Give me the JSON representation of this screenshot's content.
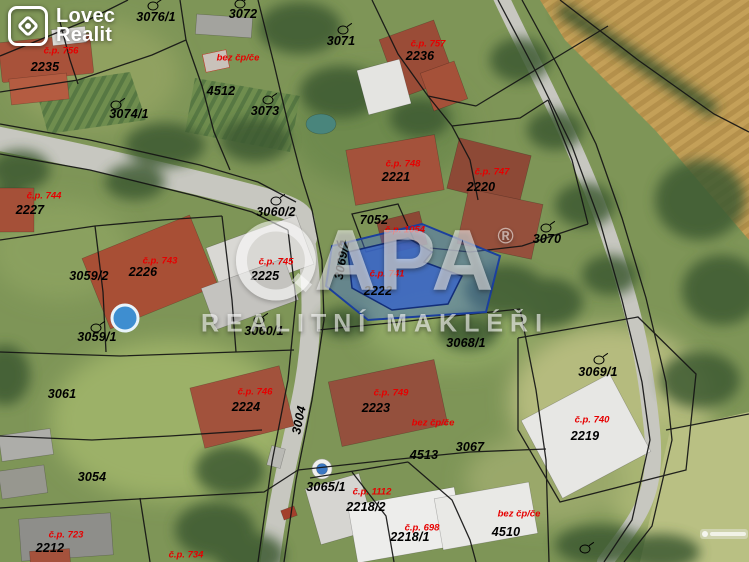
{
  "logo": {
    "line1": "Lovec",
    "line2": "Realit"
  },
  "watermark": {
    "brand": "APA",
    "registered": "®",
    "subtitle": "REALITNÍ MAKLÉŘI"
  },
  "colors": {
    "parcel_label": "#000000",
    "house_label": "#e60000",
    "highlight_fill": "#4672d7",
    "highlight_stroke": "#1b3f9e"
  },
  "map": {
    "parcel_labels": [
      {
        "text": "3076/1",
        "x": 156,
        "y": 17
      },
      {
        "text": "3072",
        "x": 243,
        "y": 14
      },
      {
        "text": "3071",
        "x": 341,
        "y": 41
      },
      {
        "text": "2236",
        "x": 420,
        "y": 56
      },
      {
        "text": "2235",
        "x": 45,
        "y": 67
      },
      {
        "text": "4512",
        "x": 221,
        "y": 91
      },
      {
        "text": "3073",
        "x": 265,
        "y": 111
      },
      {
        "text": "3074/1",
        "x": 129,
        "y": 114
      },
      {
        "text": "2227",
        "x": 30,
        "y": 210
      },
      {
        "text": "3060/2",
        "x": 276,
        "y": 212
      },
      {
        "text": "7052",
        "x": 374,
        "y": 220
      },
      {
        "text": "2221",
        "x": 396,
        "y": 177
      },
      {
        "text": "2220",
        "x": 481,
        "y": 187
      },
      {
        "text": "3070",
        "x": 547,
        "y": 239
      },
      {
        "text": "3059/2",
        "x": 89,
        "y": 276
      },
      {
        "text": "2226",
        "x": 143,
        "y": 272
      },
      {
        "text": "2225",
        "x": 265,
        "y": 276
      },
      {
        "text": "2222",
        "x": 378,
        "y": 291
      },
      {
        "text": "3069/2",
        "x": 342,
        "y": 260,
        "rot": -80
      },
      {
        "text": "3059/1",
        "x": 97,
        "y": 337
      },
      {
        "text": "3060/1",
        "x": 264,
        "y": 331
      },
      {
        "text": "3068/1",
        "x": 466,
        "y": 343
      },
      {
        "text": "3069/1",
        "x": 598,
        "y": 372
      },
      {
        "text": "3061",
        "x": 62,
        "y": 394
      },
      {
        "text": "2224",
        "x": 246,
        "y": 407
      },
      {
        "text": "3004",
        "x": 299,
        "y": 420,
        "rot": -78
      },
      {
        "text": "2223",
        "x": 376,
        "y": 408
      },
      {
        "text": "2219",
        "x": 585,
        "y": 436
      },
      {
        "text": "3067",
        "x": 470,
        "y": 447
      },
      {
        "text": "4513",
        "x": 424,
        "y": 455
      },
      {
        "text": "3054",
        "x": 92,
        "y": 477
      },
      {
        "text": "3065/1",
        "x": 326,
        "y": 487
      },
      {
        "text": "2218/2",
        "x": 366,
        "y": 507
      },
      {
        "text": "2218/1",
        "x": 410,
        "y": 537
      },
      {
        "text": "2212",
        "x": 50,
        "y": 548
      },
      {
        "text": "4510",
        "x": 506,
        "y": 532
      }
    ],
    "house_labels": [
      {
        "text": "č.p. 756",
        "x": 61,
        "y": 51
      },
      {
        "text": "bez čp/če",
        "x": 238,
        "y": 58
      },
      {
        "text": "č.p. 757",
        "x": 428,
        "y": 44
      },
      {
        "text": "č.p. 744",
        "x": 44,
        "y": 196
      },
      {
        "text": "č.p. 743",
        "x": 160,
        "y": 261
      },
      {
        "text": "č.p. 745",
        "x": 276,
        "y": 262
      },
      {
        "text": "č.p. 748",
        "x": 403,
        "y": 164
      },
      {
        "text": "č.p. 747",
        "x": 492,
        "y": 172
      },
      {
        "text": "č.p. 1054",
        "x": 405,
        "y": 230
      },
      {
        "text": "č.p. 741",
        "x": 387,
        "y": 274
      },
      {
        "text": "č.p. 746",
        "x": 255,
        "y": 392
      },
      {
        "text": "č.p. 749",
        "x": 391,
        "y": 393
      },
      {
        "text": "bez čp/če",
        "x": 433,
        "y": 423
      },
      {
        "text": "č.p. 740",
        "x": 592,
        "y": 420
      },
      {
        "text": "č.p. 1112",
        "x": 372,
        "y": 492
      },
      {
        "text": "č.p. 698",
        "x": 422,
        "y": 528
      },
      {
        "text": "bez čp/če",
        "x": 519,
        "y": 514
      },
      {
        "text": "č.p. 723",
        "x": 66,
        "y": 535
      },
      {
        "text": "č.p. 734",
        "x": 186,
        "y": 555
      }
    ],
    "circle_symbols": [
      {
        "x": 153,
        "y": 6
      },
      {
        "x": 240,
        "y": 4
      },
      {
        "x": 343,
        "y": 30
      },
      {
        "x": 268,
        "y": 100
      },
      {
        "x": 116,
        "y": 105
      },
      {
        "x": 276,
        "y": 201
      },
      {
        "x": 546,
        "y": 228
      },
      {
        "x": 96,
        "y": 328
      },
      {
        "x": 259,
        "y": 320
      },
      {
        "x": 599,
        "y": 360
      },
      {
        "x": 585,
        "y": 549
      }
    ],
    "chevron_symbols": [
      {
        "x": 339,
        "y": 244
      }
    ]
  }
}
